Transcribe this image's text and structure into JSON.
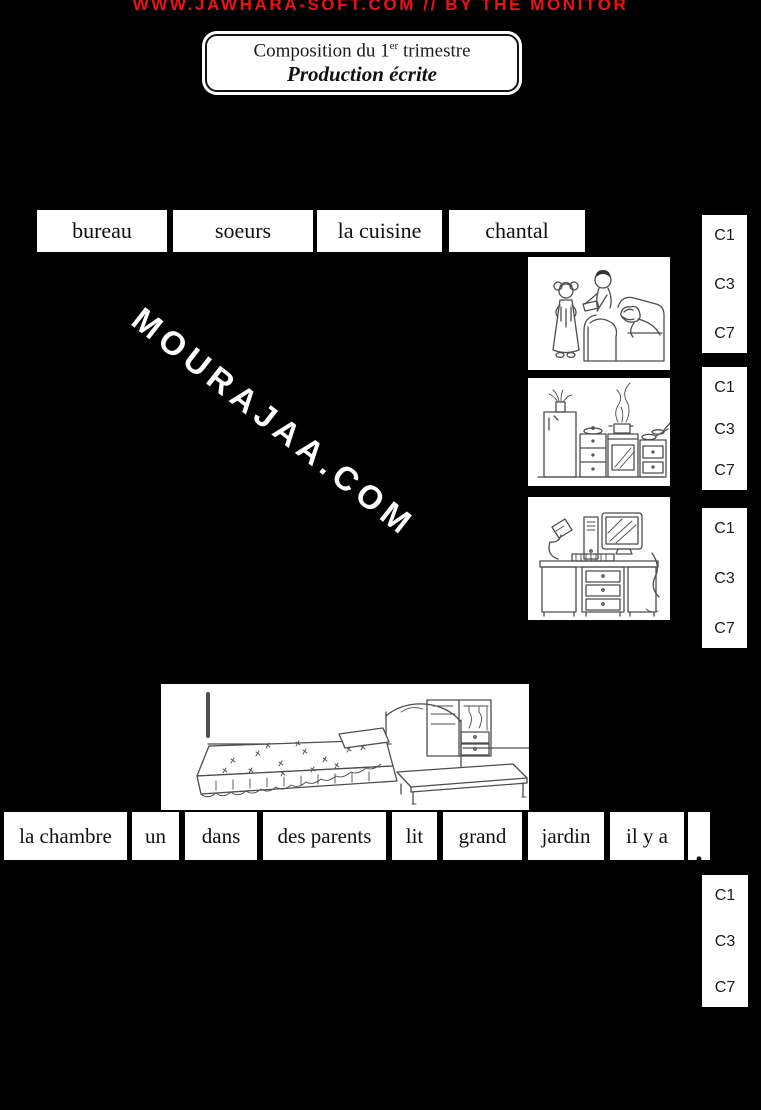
{
  "banner": {
    "text": "WWW.JAWHARA-SOFT.COM // BY THE MONITOR",
    "color": "#ee1111"
  },
  "title_box": {
    "line1_prefix": "Composition du 1",
    "line1_sup": "er",
    "line1_suffix": " trimestre",
    "line2": "Production écrite"
  },
  "word_bank_top": [
    "bureau",
    "soeurs",
    "la cuisine",
    "chantal"
  ],
  "criteria_labels": [
    "C1",
    "C3",
    "C7"
  ],
  "watermark": {
    "text": "MOURAJAA.COM"
  },
  "word_bank_bottom": [
    "la chambre",
    "un",
    "dans",
    "des parents",
    "lit",
    "grand",
    "jardin",
    "il y a",
    "."
  ],
  "illustrations": [
    {
      "name": "family-reading-illustration",
      "subject": "children giving a gift to mother on sofa"
    },
    {
      "name": "kitchen-illustration",
      "subject": "kitchen with fridge, stove and counters"
    },
    {
      "name": "computer-desk-illustration",
      "subject": "desk with computer, lamp and cat"
    },
    {
      "name": "bedroom-illustration",
      "subject": "bedroom with bed, low table and wardrobe"
    }
  ],
  "colors": {
    "background": "#000000",
    "card": "#ffffff",
    "text": "#111111",
    "banner_red": "#ee1111"
  }
}
